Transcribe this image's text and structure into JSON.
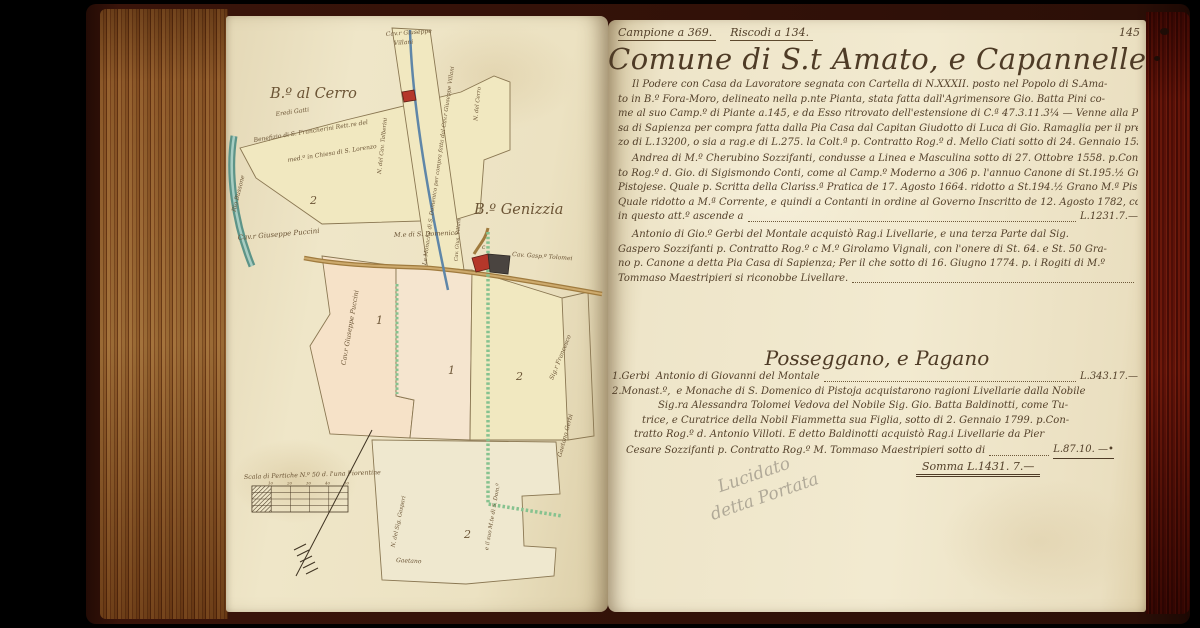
{
  "palette": {
    "background": "#000000",
    "cover": "#2c0f07",
    "page": "#efe6c8",
    "ink": "#53402a",
    "fore_edge_left": "#b78e5e",
    "fore_edge_right": "#93392a",
    "parcel_yellow": "#f1e8c0",
    "parcel_peach": "#f6e2c8",
    "river_teal": "#5d9488",
    "path_green": "#86c28f",
    "building_red": "#b5372a",
    "road_tan": "#a07b3e"
  },
  "right_page": {
    "header": {
      "left": "Campione a 369.",
      "center": "Riscodi a 134.",
      "page_number": "145"
    },
    "title": "Comune di S.t Amato, e Capannelle",
    "para1_lines": [
      "Il Podere con Casa da Lavoratore segnata con Cartella di N.XXXII. posto nel Popolo di S.Ama-",
      "to in B.º Fora-Moro, delineato nella p.nte Pianta, stata fatta dall'Agrimensore Gio. Batta Pini co-",
      "me al suo Camp.º di Piante a.145, e da Esso ritrovato dell'estensione di C.ª 47.3.11.3¼ — Venne alla Pia Ca-",
      "sa di Sapienza per compra fatta dalla Pia Casa dal Capitan Giudotto di Luca di Gio. Ramaglia per il prez-",
      "zo di L.13200, o sia a rag.e di L.275. la Colt.ª p. Contratto Rog.º d. Mello Ciati sotto di 24. Gennaio 1556."
    ],
    "para2_lines": [
      "Andrea di M.º Cherubino Sozzifanti, condusse a Linea e Masculina sotto di 27. Ottobre 1558. p.Contrat-",
      "to Rog.º d. Gio. di Sigismondo Conti, come al Camp.º Moderno a 306 p. l'annuo Canone di St.195.½ Grano M.ª",
      "Pistojese. Quale p. Scritta della Clariss.ª Pratica de 17. Agosto 1664. ridotto a St.194.½ Grano M.ª Pistojese.",
      "Quale ridotto a M.ª Corrente, e quindi a Contanti in ordine al Governo Inscritto de 12. Agosto 1782, come",
      "in questo att.º ascende a"
    ],
    "para2_amount": "L.1231.7.—",
    "para3_lines": [
      "Antonio di Gio.º Gerbi del Montale acquistò Rag.i Livellarie, e una terza Parte dal Sig.",
      "Gaspero Sozzifanti p. Contratto Rog.º c M.º Girolamo Vignali, con l'onere di St. 64. e St. 50 Gra-",
      "no p. Canone a detta Pia Casa di Sapienza; Per il che sotto di 16. Giugno 1774. p. i Rogiti di M.º",
      "Tommaso Maestripieri si riconobbe Livellare."
    ],
    "section": {
      "heading": "Posseggano, e Pagano",
      "margin1": "1.Gerbi",
      "line1": "Antonio di Giovanni del Montale",
      "amount1": "L.343.17.—",
      "margin2": "2.Monast.º,",
      "line2": "e Monache di S. Domenico di Pistoja acquistarono ragioni Livellarie dalla Nobile",
      "line3": "Sig.ra Alessandra Tolomei Vedova del Nobile Sig. Gio. Batta Baldinotti, come Tu-",
      "line4": "trice, e Curatrice della Nobil Fiammetta sua Figlia, sotto di 2. Gennaio 1799. p.Con-",
      "line5": "tratto Rog.º d. Antonio Villoti. E detto Baldinotti acquistò Rag.i Livellarie da Pier",
      "line6": "Cesare Sozzifanti p. Contratto Rog.º M. Tommaso Maestripieri sotto di",
      "amount2": "L.87.10. —•",
      "sum_label": "Somma",
      "sum_value": "L.1431. 7.—"
    },
    "pencil_note": {
      "line1": "Lucidato",
      "line2": "detta Portata"
    }
  },
  "map": {
    "district_cerro": "B.º al Cerro",
    "district_genizzia": "B.º Genizzia",
    "cerro_note1": "Eredi Gatti",
    "cerro_note2": "Benefizio di S. Francherini Rett.re del",
    "cerro_note3": "med.º in Chiesa di S. Lorenzo",
    "river_label": "Rio Bussone",
    "road_cerro": "N. del Cerro",
    "strip_owner_line1": "Cav.r Giuseppe",
    "strip_owner_line2": "Villani",
    "strip_left_label": "N. del Cav. Talberini",
    "strip_right_label": "Le Monache di S. Domenico per compra fatta dal Cav.r Giuseppe Villani",
    "puccini_top": "Cav.r Giuseppe Puccini",
    "domenico_road": "M.e di S. Domenico",
    "villani_small": "Cav. Gius. Villani",
    "tolomei": "Cav. Gasp.º Tolomei",
    "puccini_side": "Cav.r Giuseppe Puccini",
    "building_letter": "c",
    "right_edge_top": "Sig.r Francesco",
    "right_edge_bottom": "Gaetano Gerbi",
    "bottom_left": "N. del Sig. Gaspari",
    "bottom_center": "Gaetano",
    "bottom_right": "e il suo M.te di S. Dom.º",
    "scale_label": "Scala di Pertiche N.º 50 d. l'una Fiorentine",
    "scale_ticks": [
      "10",
      "20",
      "30",
      "40",
      "50"
    ],
    "parcel_numbers": {
      "cerro": "2",
      "p1a": "1",
      "p1b": "1",
      "p2a": "2",
      "p2b": "2"
    }
  }
}
